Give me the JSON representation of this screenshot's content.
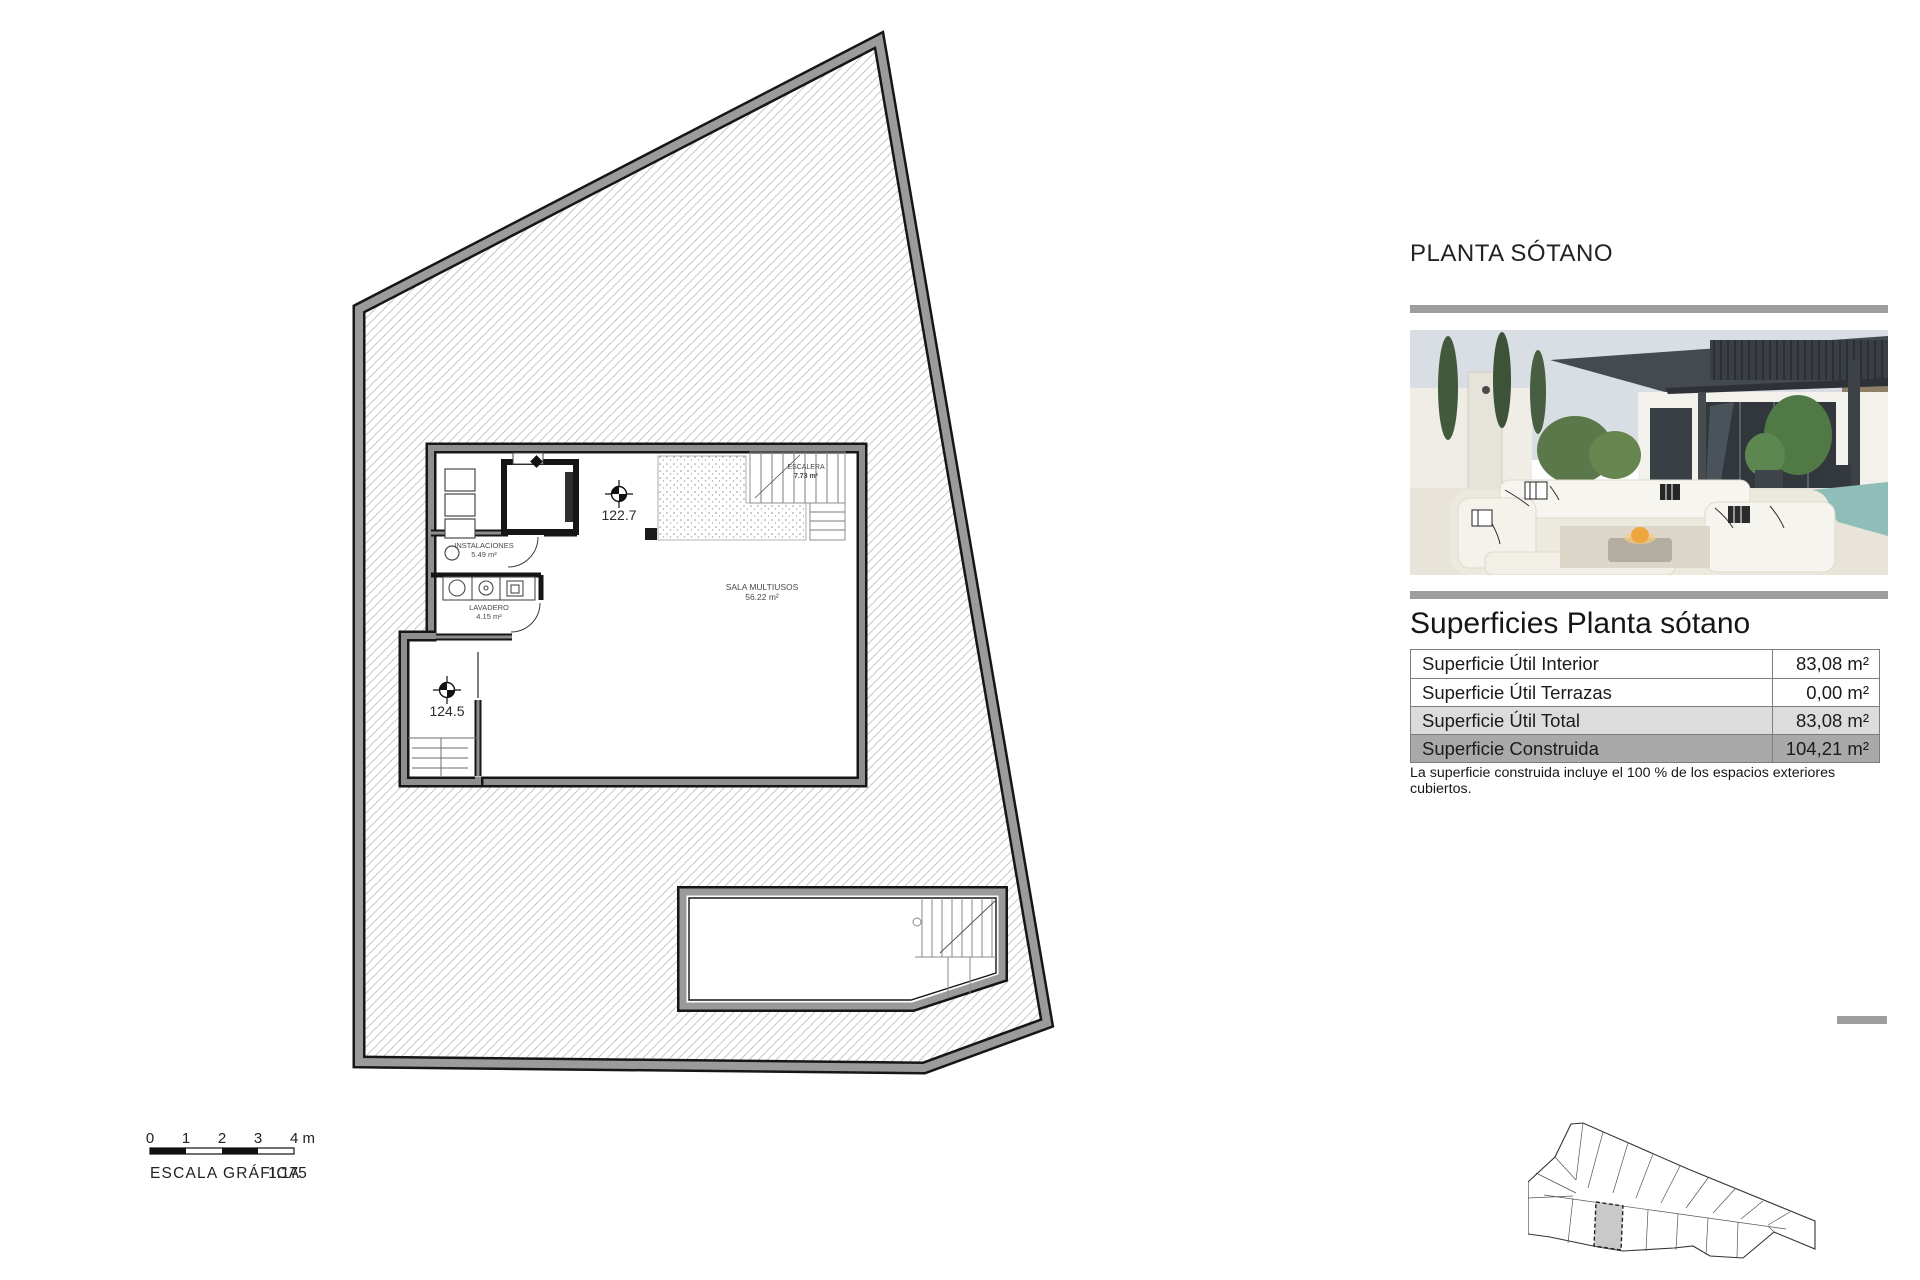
{
  "header": {
    "title": "PLANTA SÓTANO"
  },
  "plan": {
    "levels": [
      {
        "value": "122.7"
      },
      {
        "value": "124.5"
      }
    ],
    "rooms": [
      {
        "name": "INSTALACIONES",
        "area": "5.49 m²"
      },
      {
        "name": "LAVADERO",
        "area": "4.15 m²"
      },
      {
        "name": "SALA MULTIUSOS",
        "area": "56.22 m²"
      },
      {
        "name": "ESCALERA",
        "area": "7.73 m²"
      }
    ]
  },
  "scalebar": {
    "ticks": [
      "0",
      "1",
      "2",
      "3"
    ],
    "end_label": "4 m",
    "caption": "ESCALA GRÁFICA",
    "ratio": "1:175"
  },
  "surfaces": {
    "title": "Superficies Planta sótano",
    "rows": [
      {
        "label": "Superficie Útil Interior",
        "value": "83,08 m²"
      },
      {
        "label": "Superficie Útil Terrazas",
        "value": "0,00 m²"
      },
      {
        "label": "Superficie Útil Total",
        "value": "83,08 m²"
      },
      {
        "label": "Superficie Construida",
        "value": "104,21 m²"
      }
    ],
    "note": "La superficie construida incluye el 100 % de los espacios exteriores cubiertos."
  },
  "colors": {
    "divider_gray": "#9d9d9d",
    "plot_band_gray": "#9b9b9b",
    "wall_gray": "#8e8e8e",
    "row_total_bg": "#dcdcdc",
    "row_construida_bg": "#a9a9a9"
  }
}
